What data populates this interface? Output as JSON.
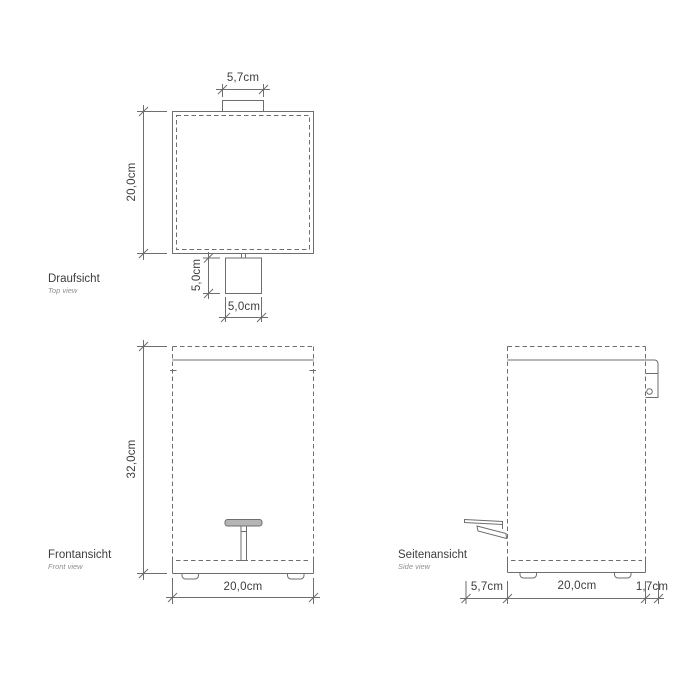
{
  "canvas": {
    "background": "#ffffff"
  },
  "colors": {
    "line": "#6e6e6e",
    "text": "#3d3d3d",
    "subtext": "#909090",
    "pedal_fill": "#b5b5b5"
  },
  "views": {
    "top": {
      "label": "Draufsicht",
      "sublabel": "Top view",
      "dims": {
        "lid_hinge_width": "5,7cm",
        "body_depth": "20,0cm",
        "pedal_depth": "5,0cm",
        "pedal_width": "5,0cm"
      }
    },
    "front": {
      "label": "Frontansicht",
      "sublabel": "Front view",
      "dims": {
        "body_height": "32,0cm",
        "body_width": "20,0cm"
      }
    },
    "side": {
      "label": "Seitenansicht",
      "sublabel": "Side view",
      "dims": {
        "pedal_projection": "5,7cm",
        "body_depth": "20,0cm",
        "hinge_projection": "1,7cm"
      }
    }
  }
}
